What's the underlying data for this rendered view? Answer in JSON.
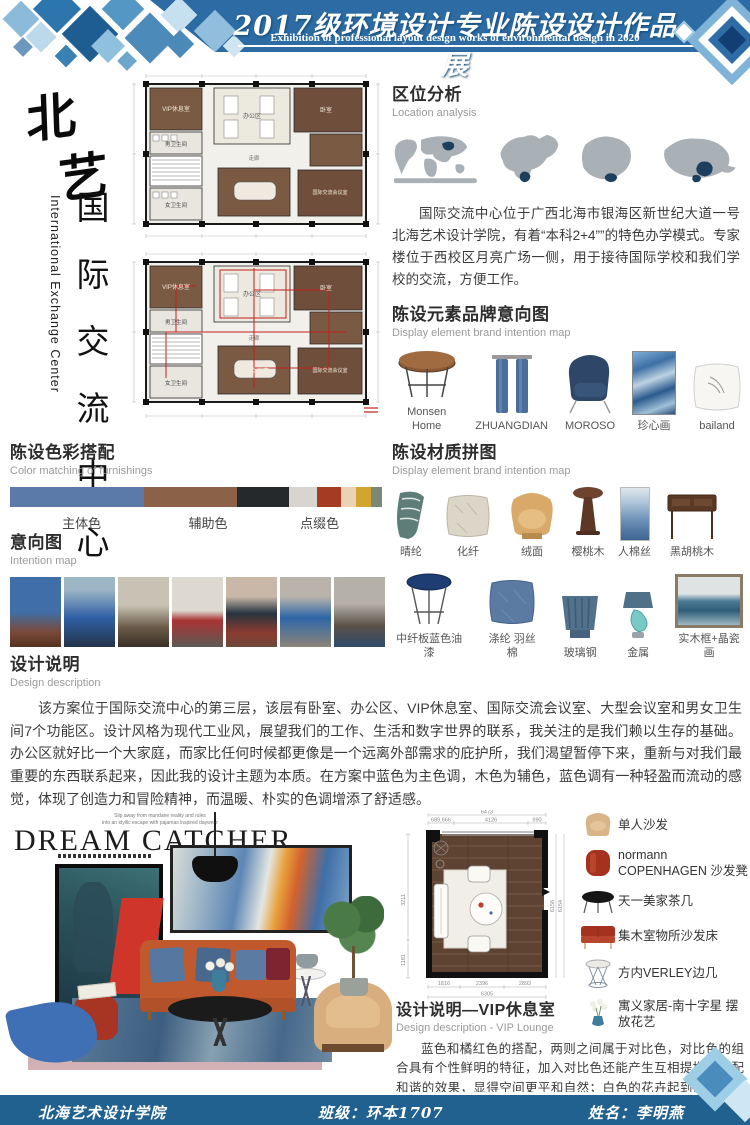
{
  "palette": {
    "header_blue": "#2c6ba3",
    "footer_blue": "#20618f",
    "navy": "#0d3c63",
    "swatches": [
      "#5b79a9",
      "#8b6147",
      "#26292b",
      "#d8d5d0",
      "#a53c22",
      "#ead3b4",
      "#d2a52f",
      "#7c8876"
    ],
    "plan_wood": "#7b5a44",
    "accent_red": "#c0392b"
  },
  "header": {
    "title": "2017级环境设计专业陈设设计作品展",
    "subtitle": "Exhibition of professional layout design works of environmental design in 2020"
  },
  "logo": {
    "char1": "北",
    "char2": "艺"
  },
  "side_title": {
    "zh": "国际交流中心",
    "en": "International Exchange Center"
  },
  "plans": {
    "rooms": {
      "vip": "VIP休息室",
      "male_wc": "男卫生间",
      "female_wc": "女卫生间",
      "office": "办公区",
      "corridor": "走廊",
      "large_meeting": "大型会议室",
      "bedroom": "卧室",
      "intl_meeting": "国际交流会议室"
    }
  },
  "location": {
    "heading": "区位分析",
    "subheading": "Location analysis",
    "paragraph": "国际交流中心位于广西北海市银海区新世纪大道一号北海艺术设计学院，有着“本科2+4””的特色办学模式。专家楼位于西校区月亮广场一侧，用于接待国际学校和我们学校的交流，方便工作。"
  },
  "brand": {
    "heading": "陈设元素品牌意向图",
    "subheading": "Display element brand intention map",
    "items": [
      {
        "label": "Monsen Home"
      },
      {
        "label": "ZHUANGDIAN"
      },
      {
        "label": "MOROSO"
      },
      {
        "label": "珍心画"
      },
      {
        "label": "bailand"
      }
    ]
  },
  "colors_section": {
    "heading": "陈设色彩搭配",
    "subheading": "Color matching of furnishings",
    "labels": [
      "主体色",
      "辅助色",
      "点缀色"
    ]
  },
  "intention": {
    "heading": "意向图",
    "subheading": "Intention map"
  },
  "materials": {
    "heading": "陈设材质拼图",
    "subheading": "Display element brand intention map",
    "row1": [
      {
        "label": "晴纶"
      },
      {
        "label": "化纤"
      },
      {
        "label": "绒面"
      },
      {
        "label": "樱桃木"
      },
      {
        "label": "人棉丝"
      },
      {
        "label": "黑胡桃木"
      }
    ],
    "row2": [
      {
        "label": "中纤板蓝色油漆"
      },
      {
        "label": "涤纶 羽丝棉"
      },
      {
        "label": "玻璃钢"
      },
      {
        "label": "金属"
      },
      {
        "label": "实木框+晶瓷画"
      }
    ]
  },
  "design_desc": {
    "heading": "设计说明",
    "subheading": "Design description",
    "paragraph": "该方案位于国际交流中心的第三层，该层有卧室、办公区、VIP休息室、国际交流会议室、大型会议室和男女卫生间7个功能区。设计风格为现代工业风，展望我们的工作、生活和数字世界的联系，我关注的是我们赖以生存的基础。办公区就好比一个大家庭，而家比任何时候都更像是一个远离外部需求的庇护所，我们渴望暂停下来，重新与对我们最重要的东西联系起来，因此我的设计主题为本质。在方案中蓝色为主色调，木色为辅色，蓝色调有一种轻盈而流动的感觉，体现了创造力和冒险精神，而温暖、朴实的色调增添了舒适感。"
  },
  "collage": {
    "tagline1": "Slip away from mundane reality and rules",
    "tagline2": "into an idyllic escape with pajamas inspired daywear",
    "title": "DREAM CATCHER"
  },
  "vip_plan": {
    "dims": {
      "top_total": "6473",
      "top_segs": [
        "689,666",
        "4126",
        "990"
      ],
      "bottom_segs": [
        "1816",
        "2396",
        "2893"
      ],
      "bottom_total": "6305",
      "right": [
        "6156",
        "6154"
      ],
      "left": [
        "3211",
        "1181"
      ]
    }
  },
  "vip_desc": {
    "heading": "设计说明—VIP休息室",
    "subheading": "Design description - VIP Lounge",
    "paragraph": "蓝色和橘红色的搭配，两则之间属于对比色，对比色的组合具有个性鲜明的特征，加入对比色还能产生互相提携，搭配和谐的效果，显得空间更平和自然；白色的花卉起到点缀的作用。"
  },
  "furniture": {
    "items": [
      {
        "label": "单人沙发"
      },
      {
        "label": "normann COPENHAGEN 沙发凳"
      },
      {
        "label": "天一美家茶几"
      },
      {
        "label": "集木室物所沙发床"
      },
      {
        "label": "方内VERLEY边几"
      },
      {
        "label": "寓义家居-南十字星 摆放花艺"
      }
    ]
  },
  "footer": {
    "school": "北海艺术设计学院",
    "class_label": "班级：环本1707",
    "name_label": "姓名：李明燕"
  }
}
